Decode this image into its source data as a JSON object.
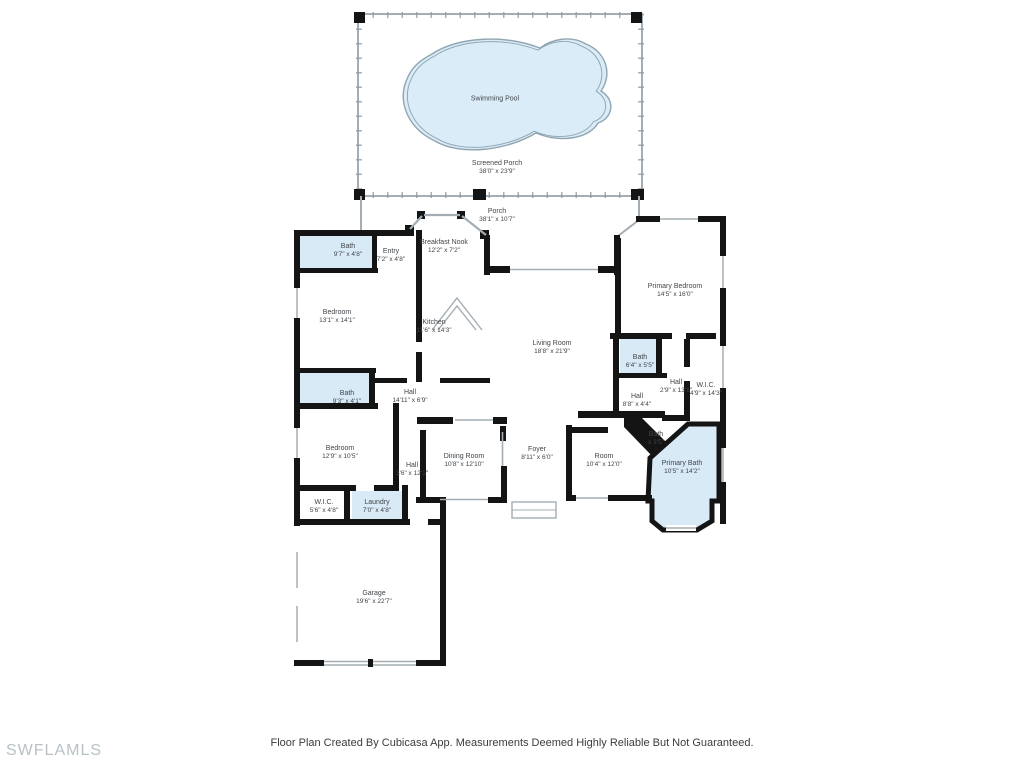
{
  "meta": {
    "title": "Residential floor plan",
    "footer_note": "Floor Plan Created By Cubicasa App. Measurements Deemed Highly Reliable But Not Guaranteed.",
    "watermark": "SWFLAMLS"
  },
  "colors": {
    "wall": "#141414",
    "wet_room_fill": "#d9eaf7",
    "pool_fill": "#daecf8",
    "pool_stroke": "#8fa6b2",
    "thin_line": "#a3adb3",
    "label_text": "#40454a",
    "watermark_text": "#b8c2c5"
  },
  "plan": {
    "rooms": [
      {
        "name": "Swimming Pool",
        "dims": ""
      },
      {
        "name": "Screened Porch",
        "dims": "38'0\" x 23'9\""
      },
      {
        "name": "Porch",
        "dims": "38'1\" x 10'7\""
      },
      {
        "name": "Bath",
        "dims": "9'7\" x 4'8\""
      },
      {
        "name": "Entry",
        "dims": "7'2\" x 4'8\""
      },
      {
        "name": "Breakfast Nook",
        "dims": "12'2\" x 7'2\""
      },
      {
        "name": "Bedroom",
        "dims": "13'1\" x 14'1\""
      },
      {
        "name": "Kitchen",
        "dims": "11'6\" x 14'3\""
      },
      {
        "name": "Living Room",
        "dims": "18'8\" x 21'9\""
      },
      {
        "name": "Primary Bedroom",
        "dims": "14'5\" x 16'0\""
      },
      {
        "name": "Bath",
        "dims": "6'4\" x 5'5\""
      },
      {
        "name": "Hall",
        "dims": "2'9\" x 13'1\""
      },
      {
        "name": "W.I.C.",
        "dims": "4'9\" x 14'3\""
      },
      {
        "name": "Hall",
        "dims": "8'8\" x 4'4\""
      },
      {
        "name": "Bath",
        "dims": "9'3\" x 4'1\""
      },
      {
        "name": "Hall",
        "dims": "14'11\" x 6'9\""
      },
      {
        "name": "Bedroom",
        "dims": "12'9\" x 10'5\""
      },
      {
        "name": "Hall",
        "dims": "3'6\" x 12'1\""
      },
      {
        "name": "Dining Room",
        "dims": "10'8\" x 12'10\""
      },
      {
        "name": "Foyer",
        "dims": "8'11\" x 6'0\""
      },
      {
        "name": "Room",
        "dims": "10'4\" x 12'0\""
      },
      {
        "name": "Bath",
        "dims": "x 3'5\""
      },
      {
        "name": "Primary Bath",
        "dims": "10'5\" x 14'2\""
      },
      {
        "name": "W.I.C.",
        "dims": "5'6\" x 4'8\""
      },
      {
        "name": "Laundry",
        "dims": "7'0\" x 4'8\""
      },
      {
        "name": "Garage",
        "dims": "19'6\" x 22'7\""
      }
    ]
  }
}
